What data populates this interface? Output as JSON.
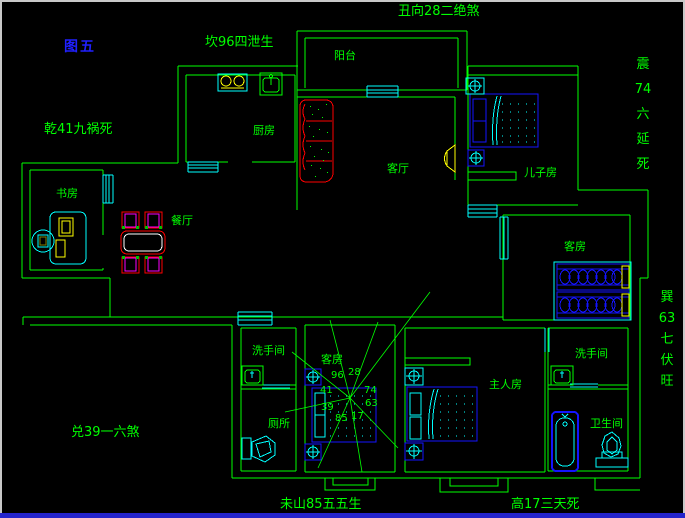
{
  "figure_label": "图五",
  "annotations": {
    "north": "坎96四泄生",
    "northeast": "丑向28二绝煞",
    "northwest": "乾41九祸死",
    "east_vertical": "震\n74\n六\n延\n死",
    "southeast_vertical": "巽\n63\n七\n伏\n旺",
    "west": "兑39一六煞",
    "southwest": "未山85五五生",
    "south": "高17三天死"
  },
  "rooms": {
    "balcony": "阳台",
    "kitchen": "厨房",
    "study": "书房",
    "dining": "餐厅",
    "living": "客厅",
    "son_bedroom": "儿子房",
    "guest_bedroom": "客房",
    "washroom_center": "洗手间",
    "toilet_room": "厕所",
    "guest_bedroom_2": "客房",
    "master_bedroom": "主人房",
    "washroom_right": "洗手间",
    "bathroom": "卫生间"
  },
  "compass_numbers": {
    "n96": "96",
    "n28": "28",
    "n41": "41",
    "n74": "74",
    "n39": "39",
    "n63": "63",
    "n85": "85",
    "n17": "17"
  },
  "colors": {
    "wall": "#00ff00",
    "fixture": "#00ffff",
    "furniture_blue": "#1414ff",
    "accent_red": "#ff0000",
    "accent_magenta": "#ff00ff",
    "accent_yellow": "#ffff00",
    "figure_label_blue": "#2020ff",
    "status_strip": "#2424cc"
  }
}
